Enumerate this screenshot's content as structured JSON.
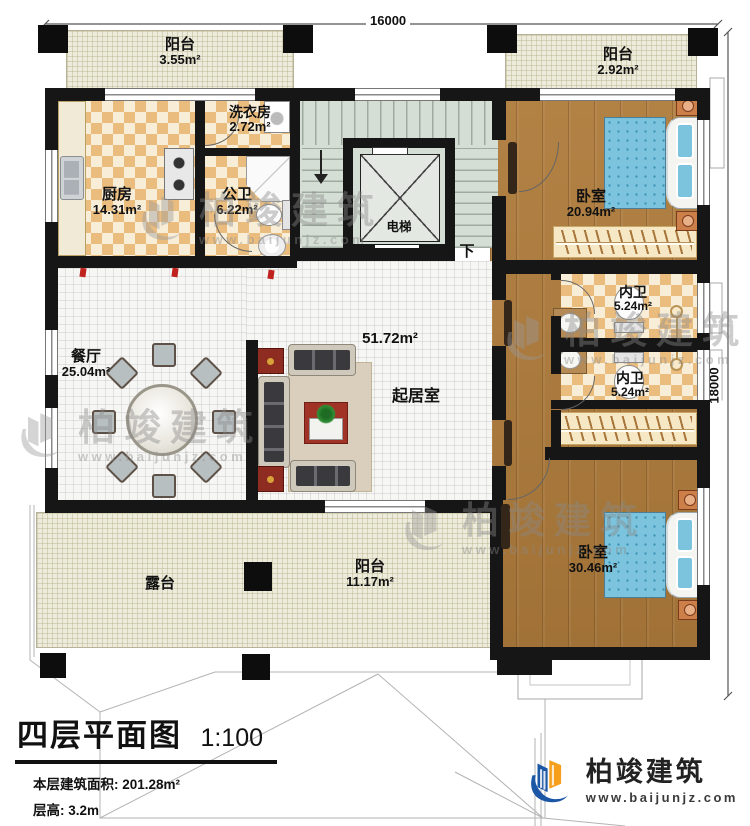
{
  "dimensions": {
    "top": "16000",
    "right": "18000"
  },
  "rooms": {
    "balcony_top_left": {
      "label": "阳台",
      "area": "3.55m²"
    },
    "laundry": {
      "label": "洗衣房",
      "area": "2.72m²"
    },
    "kitchen": {
      "label": "厨房",
      "area": "14.31m²"
    },
    "public_bath": {
      "label": "公卫",
      "area": "6.22m²"
    },
    "elevator": {
      "label": "电梯"
    },
    "stairs": {
      "down_label": "下"
    },
    "balcony_top_right": {
      "label": "阳台",
      "area": "2.92m²"
    },
    "bedroom_top": {
      "label": "卧室",
      "area": "20.94m²"
    },
    "bath_upper": {
      "label": "内卫",
      "area": "5.24m²"
    },
    "bath_lower": {
      "label": "内卫",
      "area": "5.24m²"
    },
    "dining": {
      "label": "餐厅",
      "area": "25.04m²"
    },
    "living": {
      "label": "起居室",
      "area": "51.72m²"
    },
    "bedroom_bottom": {
      "label": "卧室",
      "area": "30.46m²"
    },
    "balcony_bottom": {
      "label": "阳台",
      "area": "11.17m²"
    },
    "terrace": {
      "label": "露台"
    }
  },
  "title_block": {
    "title": "四层平面图",
    "scale": "1:100",
    "area_line": "本层建筑面积: 201.28m²",
    "height_line": "层高: 3.2m"
  },
  "brand": {
    "name": "柏竣建筑",
    "website": "www.baijunjz.com",
    "blue": "#1c57a5",
    "orange": "#f59f1d"
  }
}
